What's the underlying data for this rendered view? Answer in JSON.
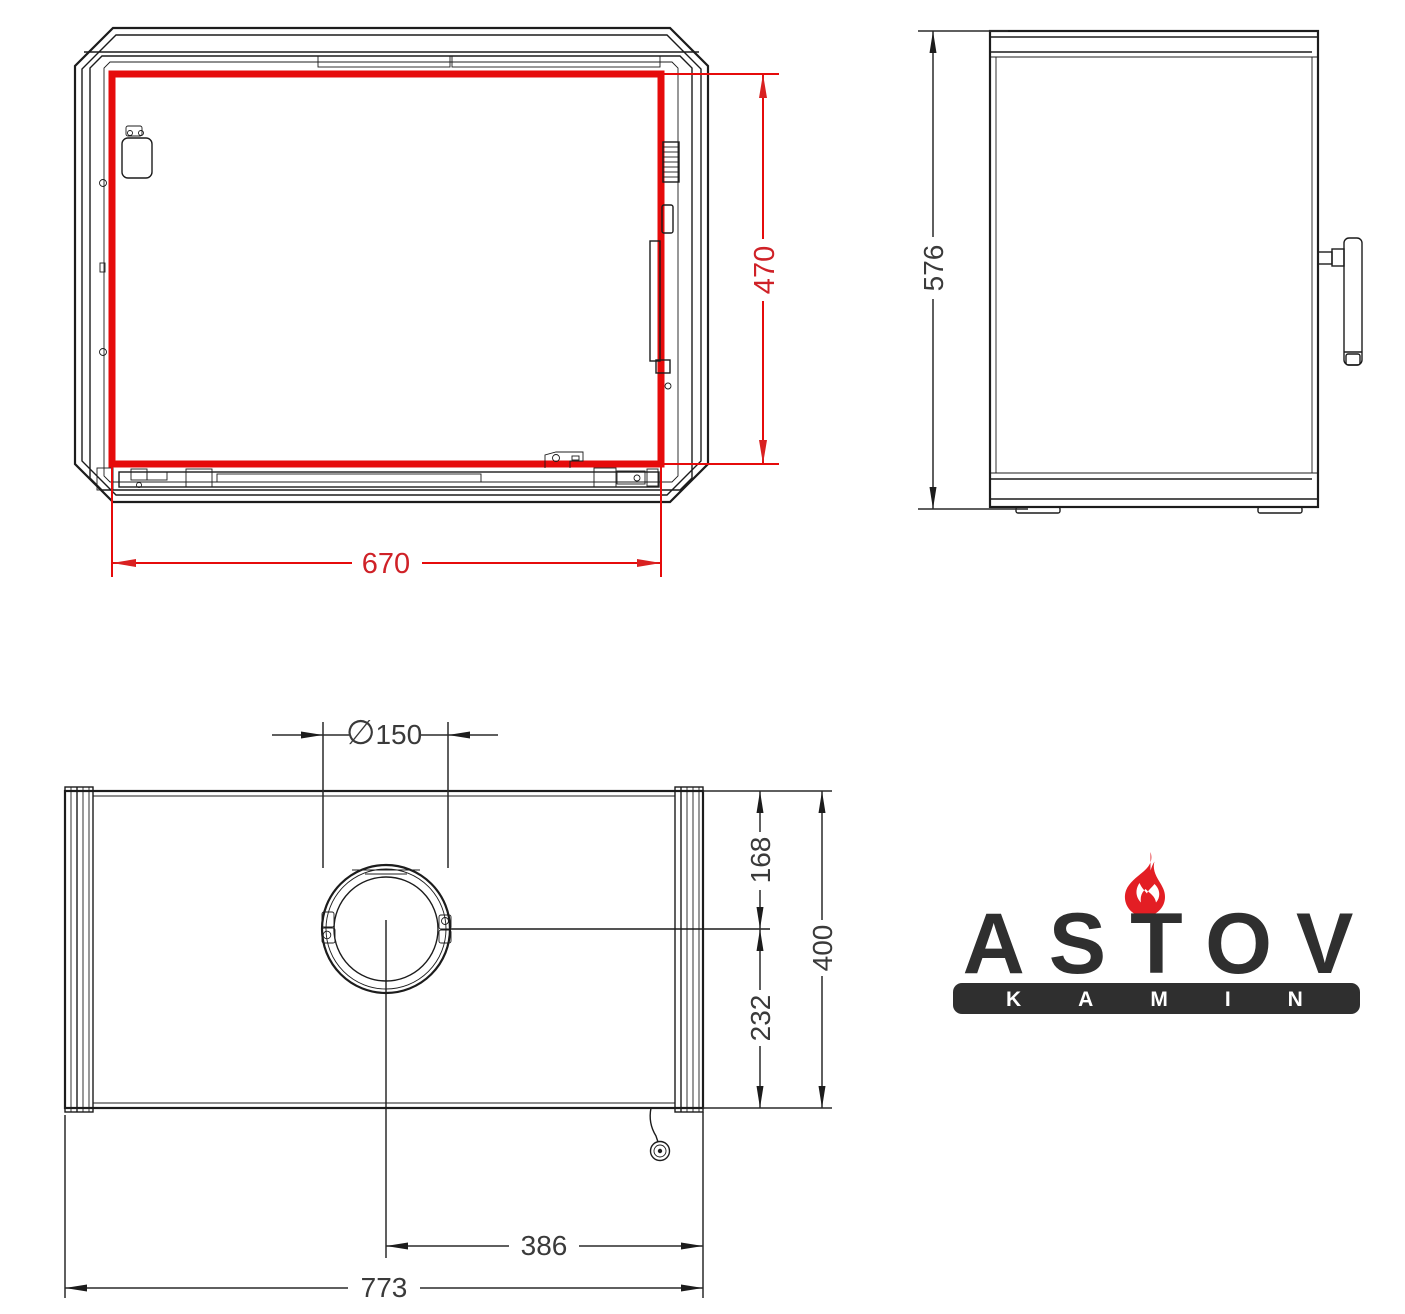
{
  "drawing": {
    "front_view": {
      "door_glass_width": "670",
      "door_glass_height": "470"
    },
    "side_view": {
      "overall_height": "576"
    },
    "top_view": {
      "flue_diameter_prefix": "∅",
      "flue_diameter": "150",
      "flue_center_from_back": "168",
      "overall_depth": "400",
      "flue_center_to_front": "232",
      "flue_center_from_right": "386",
      "overall_width": "773"
    },
    "colors": {
      "line": "#1c1c1c",
      "highlight_red": "#e60b0b",
      "dimension_red": "#cf2127",
      "dimension_text": "#3a3a3a"
    }
  },
  "logo": {
    "brand": "ASTOV",
    "subbrand": "KAMIN",
    "flame_color": "#e31e24",
    "text_color": "#2f2f2f",
    "bar_color": "#2f2f2f"
  }
}
